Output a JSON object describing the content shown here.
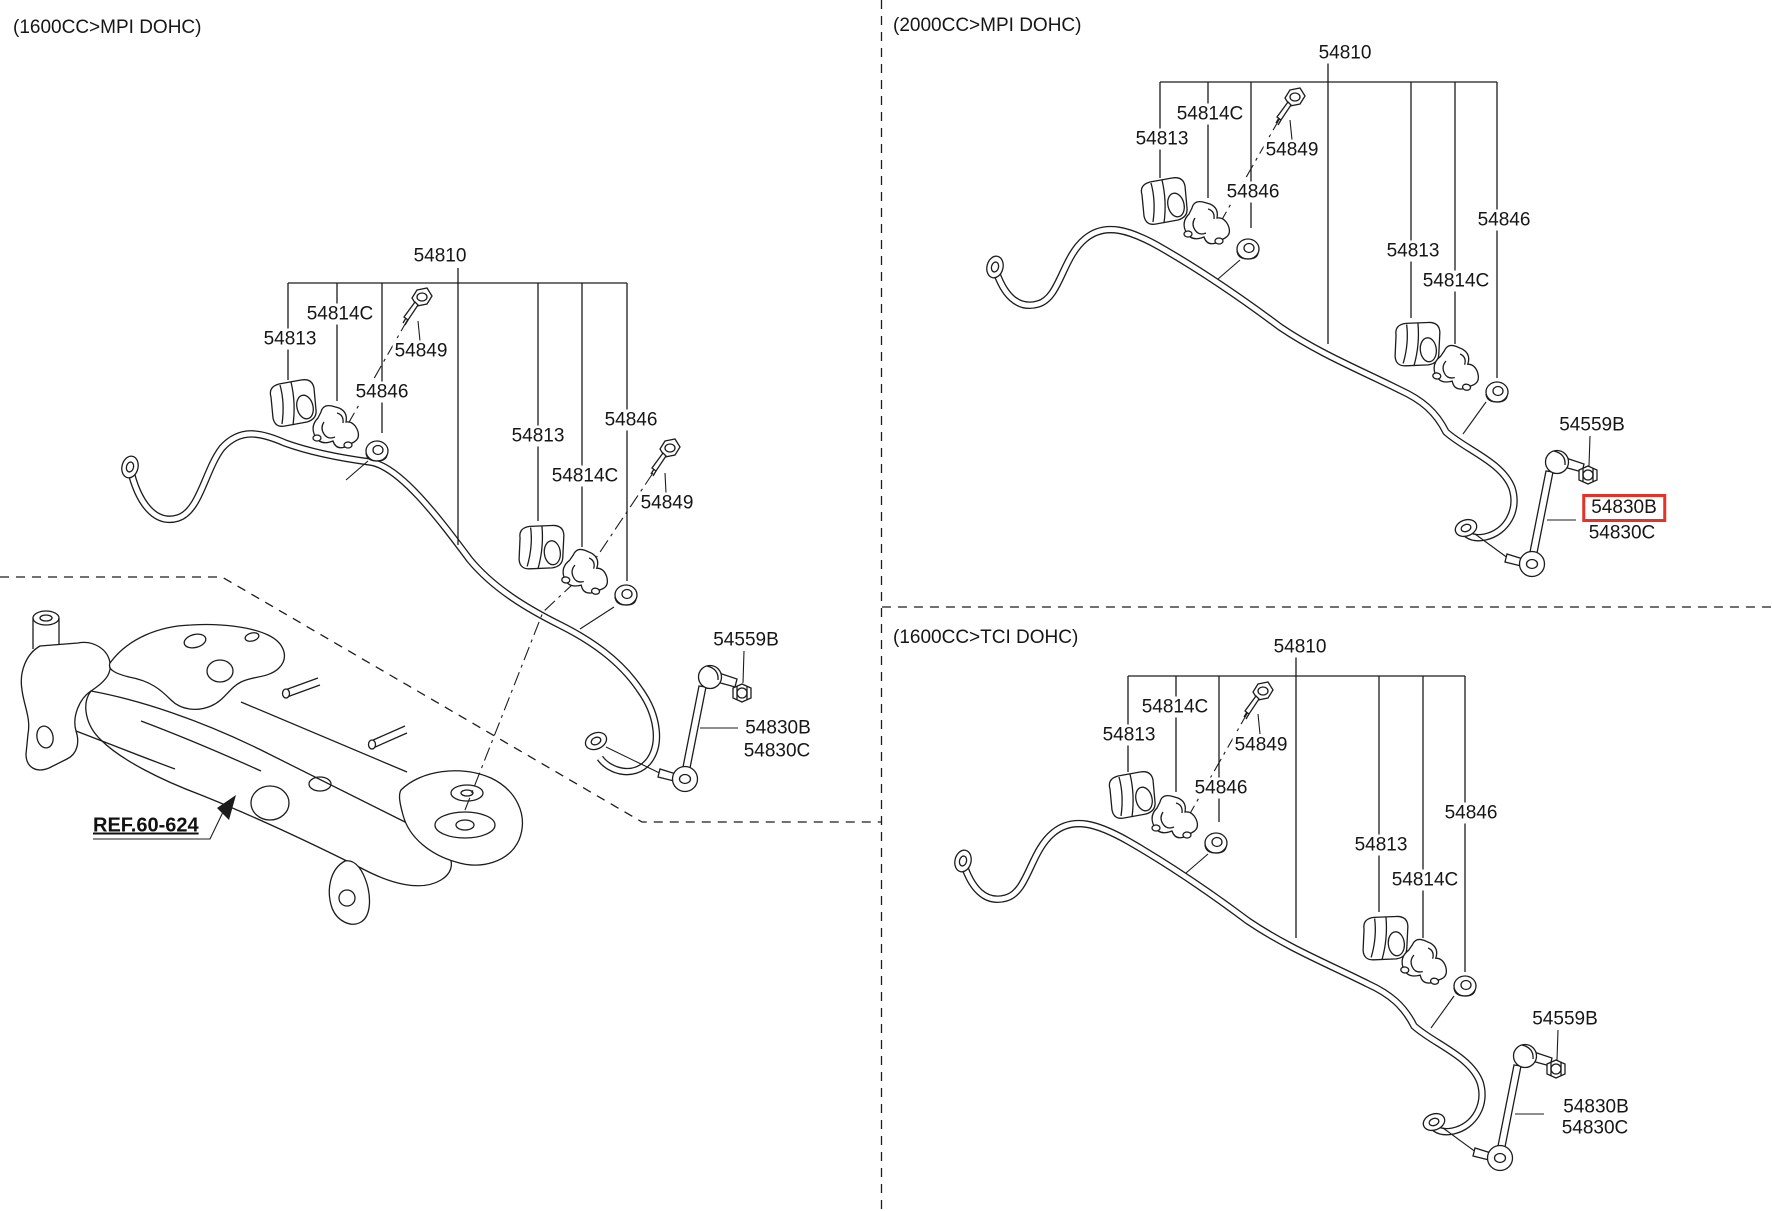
{
  "meta": {
    "highlight_color": "#e53228",
    "line_color": "#1c1c1c",
    "highlighted_part": "54830B"
  },
  "sections": {
    "s1": {
      "title": "(1600CC>MPI DOHC)",
      "ref_label": "REF.60-624",
      "labels": {
        "l54810": "54810",
        "l54813": "54813",
        "l54814c": "54814C",
        "l54849": "54849",
        "l54846": "54846",
        "l54559b": "54559B",
        "l54830b": "54830B",
        "l54830c": "54830C"
      }
    },
    "s2": {
      "title": "(2000CC>MPI DOHC)",
      "highlighted": "54830B",
      "labels": {
        "l54810": "54810",
        "l54813": "54813",
        "l54814c": "54814C",
        "l54849": "54849",
        "l54846": "54846",
        "l54559b": "54559B",
        "l54830b": "54830B",
        "l54830c": "54830C"
      }
    },
    "s3": {
      "title": "(1600CC>TCI DOHC)",
      "labels": {
        "l54810": "54810",
        "l54813": "54813",
        "l54814c": "54814C",
        "l54849": "54849",
        "l54846": "54846",
        "l54559b": "54559B",
        "l54830b": "54830B",
        "l54830c": "54830C"
      }
    }
  }
}
